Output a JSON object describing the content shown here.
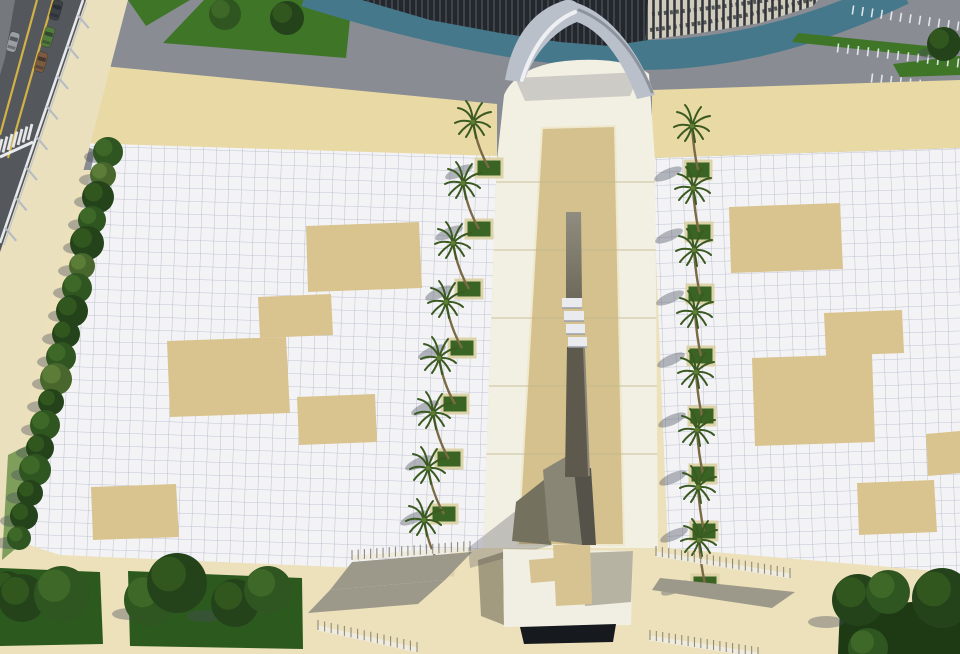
{
  "meta": {
    "label": "aerial-3d-architectural-render-monument-plaza",
    "canvas_w": 960,
    "canvas_h": 654
  },
  "palette": {
    "base": "#ece1ba",
    "asphalt": "#54575c",
    "median": "#75787d",
    "yellow": "#d2b245",
    "sidewalk": "#eae0bd",
    "rail": "#e6e9ed",
    "rail_post": "#b6bcc4",
    "pavement": "#898c92",
    "grass": "#3e7527",
    "grass_dark": "#2c5a1e",
    "lawn_dark": "#1e3a15",
    "tree_dark": "#24431a",
    "tree_mid": "#2f5520",
    "tree_light": "#49672c",
    "teal": "#45788b",
    "colonnade": "#24282d",
    "slat": "#3e444b",
    "facade": "#d0cbbc",
    "facade_win": "#33373c",
    "band": "#e9d9a4",
    "tile": "#f3f3f6",
    "tile_line": "#96a0b4",
    "patch": "#d9c48f",
    "walk_white": "#f2efe3",
    "walk_tan": "#d4c18d",
    "walk_border": "#efe8cd",
    "joint": "#c2b88f",
    "arch_mid": "#bac0ca",
    "arch_light": "#eef0f4",
    "arch_dark": "#8d939d",
    "mono_up_a": "#908d80",
    "mono_up_b": "#6e6a5b",
    "mono_low": "#5d594c",
    "mono_right": "#8a8578",
    "slab": "#e9ebee",
    "slab_edge": "#9aa0a8",
    "plat": "#f1eee4",
    "plat_shadow": "#b7b3a3",
    "pedestal": "#d6c391",
    "recess": "#16191d",
    "wedge": "#9d998a",
    "stripe_white": "#eef1f4",
    "shadow": "rgba(72,76,90,0.38)",
    "planter_frame": "#ddd3a8",
    "planter_grass": "#3a6423",
    "trunk": "#7b6a46",
    "frond": "#3a5a21",
    "frond_core": "#5d7d30"
  },
  "scene": {
    "top": {
      "pavement": [
        [
          0,
          0
        ],
        [
          960,
          0
        ],
        [
          960,
          170
        ],
        [
          0,
          170
        ]
      ],
      "grass_islands": [
        [
          [
            128,
            0
          ],
          [
            190,
            0
          ],
          [
            146,
            26
          ]
        ],
        [
          [
            204,
            0
          ],
          [
            352,
            0
          ],
          [
            346,
            58
          ],
          [
            163,
            43
          ]
        ]
      ],
      "island_trees": [
        [
          225,
          14,
          16,
          "M"
        ],
        [
          287,
          18,
          17,
          "D"
        ]
      ],
      "teal_path": "M 306,-8 C 420,28 520,48 610,54 C 700,60 800,40 902,-10",
      "teal_width": 30,
      "colonnade": [
        [
          362,
          0
        ],
        [
          430,
          20
        ],
        [
          500,
          33
        ],
        [
          560,
          42
        ],
        [
          610,
          46
        ],
        [
          648,
          40
        ],
        [
          652,
          0
        ]
      ],
      "facade": [
        [
          648,
          0
        ],
        [
          645,
          40
        ],
        [
          700,
          33
        ],
        [
          760,
          23
        ],
        [
          813,
          6
        ],
        [
          818,
          0
        ]
      ],
      "facade_bands": [
        "M 652,14 C 700,10 760,2 815,-8",
        "M 650,30 C 700,24 762,14 816,-2"
      ],
      "grass_strips": [
        [
          [
            798,
            33
          ],
          [
            938,
            47
          ],
          [
            932,
            57
          ],
          [
            792,
            42
          ]
        ],
        [
          [
            893,
            64
          ],
          [
            960,
            56
          ],
          [
            960,
            75
          ],
          [
            900,
            77
          ]
        ]
      ],
      "parking_rows": [
        {
          "x1": 853,
          "y1": 10,
          "x2": 958,
          "y2": 26,
          "n": 12
        },
        {
          "x1": 838,
          "y1": 48,
          "x2": 958,
          "y2": 63,
          "n": 13
        },
        {
          "x1": 872,
          "y1": 78,
          "x2": 958,
          "y2": 89,
          "n": 10
        }
      ],
      "corner_tree": [
        944,
        44,
        17,
        "D"
      ]
    },
    "bands": {
      "left": [
        [
          83,
          64
        ],
        [
          497,
          104
        ],
        [
          497,
          158
        ],
        [
          78,
          144
        ]
      ],
      "right": [
        [
          652,
          90
        ],
        [
          960,
          80
        ],
        [
          960,
          148
        ],
        [
          652,
          158
        ]
      ]
    },
    "plaza": {
      "left": [
        [
          78,
          143
        ],
        [
          497,
          156
        ],
        [
          483,
          548
        ],
        [
          360,
          568
        ],
        [
          60,
          555
        ],
        [
          14,
          540
        ],
        [
          95,
          150
        ]
      ],
      "right": [
        [
          652,
          158
        ],
        [
          960,
          148
        ],
        [
          960,
          573
        ],
        [
          725,
          553
        ],
        [
          668,
          548
        ]
      ],
      "patches_left": [
        [
          [
            306,
            226
          ],
          [
            419,
            222
          ],
          [
            422,
            288
          ],
          [
            308,
            292
          ]
        ],
        [
          [
            258,
            297
          ],
          [
            331,
            294
          ],
          [
            333,
            335
          ],
          [
            260,
            338
          ]
        ],
        [
          [
            167,
            341
          ],
          [
            286,
            337
          ],
          [
            290,
            413
          ],
          [
            170,
            417
          ]
        ],
        [
          [
            297,
            397
          ],
          [
            375,
            394
          ],
          [
            377,
            442
          ],
          [
            299,
            445
          ]
        ],
        [
          [
            91,
            487
          ],
          [
            176,
            484
          ],
          [
            179,
            537
          ],
          [
            93,
            540
          ]
        ]
      ],
      "patches_right": [
        [
          [
            729,
            207
          ],
          [
            840,
            203
          ],
          [
            843,
            269
          ],
          [
            731,
            273
          ]
        ],
        [
          [
            824,
            313
          ],
          [
            902,
            310
          ],
          [
            904,
            353
          ],
          [
            826,
            356
          ]
        ],
        [
          [
            752,
            358
          ],
          [
            872,
            354
          ],
          [
            875,
            442
          ],
          [
            755,
            446
          ]
        ],
        [
          [
            857,
            483
          ],
          [
            934,
            480
          ],
          [
            937,
            532
          ],
          [
            859,
            535
          ]
        ],
        [
          [
            926,
            434
          ],
          [
            960,
            431
          ],
          [
            960,
            473
          ],
          [
            928,
            476
          ]
        ]
      ]
    },
    "street": {
      "asphalt": [
        [
          0,
          0
        ],
        [
          86,
          0
        ],
        [
          0,
          252
        ]
      ],
      "median": [
        [
          0,
          0
        ],
        [
          15,
          0
        ],
        [
          5,
          58
        ],
        [
          0,
          75
        ]
      ],
      "yellow_lines": [
        [
          [
            37,
            0
          ],
          [
            0,
            135
          ]
        ],
        [
          [
            53,
            0
          ],
          [
            8,
            158
          ]
        ]
      ],
      "crosswalk": {
        "x1": 0,
        "y1": 147,
        "x2": 30,
        "y2": 132,
        "n": 7
      },
      "stop_line": [
        [
          0,
          157
        ],
        [
          33,
          142
        ]
      ],
      "rail": {
        "x1": 83,
        "y1": 0,
        "x2": 0,
        "y2": 243,
        "posts": 8
      },
      "cars": [
        {
          "x": 56,
          "y": 10,
          "c": "#3c4146"
        },
        {
          "x": 48,
          "y": 37,
          "c": "#527c3b"
        },
        {
          "x": 13,
          "y": 42,
          "c": "#9a9ea3"
        },
        {
          "x": 41,
          "y": 62,
          "c": "#7d5b40"
        }
      ],
      "sidewalk": [
        [
          83,
          0
        ],
        [
          128,
          0
        ],
        [
          60,
          260
        ],
        [
          18,
          450
        ],
        [
          0,
          540
        ],
        [
          0,
          243
        ]
      ],
      "grass_sliver": [
        [
          8,
          455
        ],
        [
          28,
          445
        ],
        [
          20,
          545
        ],
        [
          2,
          560
        ]
      ]
    },
    "hedge": [
      [
        108,
        152,
        15,
        "M"
      ],
      [
        103,
        175,
        13,
        "L"
      ],
      [
        98,
        197,
        16,
        "D"
      ],
      [
        92,
        220,
        14,
        "M"
      ],
      [
        87,
        243,
        17,
        "D"
      ],
      [
        82,
        266,
        13,
        "L"
      ],
      [
        77,
        288,
        15,
        "M"
      ],
      [
        72,
        311,
        16,
        "D"
      ],
      [
        66,
        334,
        14,
        "D"
      ],
      [
        61,
        357,
        15,
        "M"
      ],
      [
        56,
        379,
        16,
        "L"
      ],
      [
        51,
        402,
        13,
        "D"
      ],
      [
        45,
        425,
        15,
        "M"
      ],
      [
        40,
        448,
        14,
        "D"
      ],
      [
        35,
        470,
        16,
        "M"
      ],
      [
        30,
        493,
        13,
        "D"
      ],
      [
        24,
        516,
        14,
        "D"
      ],
      [
        19,
        538,
        12,
        "M"
      ]
    ],
    "walkway": {
      "outline": "M 497,160 L 504,95 C 512,76 535,64 565,61 C 605,57 636,63 649,74 L 655,160 L 658,548 L 483,548 Z",
      "tan": [
        [
          542,
          128
        ],
        [
          615,
          126
        ],
        [
          624,
          545
        ],
        [
          518,
          545
        ]
      ],
      "joints": [
        182,
        250,
        318,
        386,
        454
      ],
      "arch_shadow": [
        [
          515,
          78
        ],
        [
          640,
          72
        ],
        [
          630,
          96
        ],
        [
          525,
          101
        ]
      ]
    },
    "palms": {
      "left": [
        [
          473,
          122
        ],
        [
          463,
          183
        ],
        [
          453,
          243
        ],
        [
          446,
          302
        ],
        [
          439,
          358
        ],
        [
          433,
          413
        ],
        [
          428,
          468
        ],
        [
          424,
          520
        ]
      ],
      "right": [
        [
          692,
          126
        ],
        [
          693,
          188
        ],
        [
          694,
          250
        ],
        [
          695,
          312
        ],
        [
          696,
          372
        ],
        [
          697,
          430
        ],
        [
          698,
          487
        ],
        [
          699,
          540
        ]
      ],
      "planter_offset_left": [
        16,
        46
      ],
      "planter_offset_right": [
        6,
        44
      ]
    },
    "monument": {
      "shaft_upper": [
        [
          566,
          212
        ],
        [
          581,
          212
        ],
        [
          582,
          298
        ],
        [
          566,
          298
        ]
      ],
      "slabs": [
        [
          562,
          298,
          20,
          10
        ],
        [
          564,
          311,
          20,
          10
        ],
        [
          566,
          324,
          19,
          10
        ],
        [
          568,
          337,
          19,
          10
        ]
      ],
      "shaft_lower": [
        [
          567,
          347
        ],
        [
          584,
          347
        ],
        [
          589,
          477
        ],
        [
          565,
          477
        ]
      ],
      "base_mid": [
        [
          543,
          470
        ],
        [
          574,
          452
        ],
        [
          582,
          545
        ],
        [
          549,
          541
        ]
      ],
      "base_fin": [
        [
          516,
          502
        ],
        [
          545,
          479
        ],
        [
          551,
          545
        ],
        [
          512,
          541
        ]
      ],
      "base_right": [
        [
          574,
          470
        ],
        [
          591,
          468
        ],
        [
          596,
          545
        ],
        [
          582,
          545
        ]
      ],
      "ground_shadow": [
        [
          468,
          548
        ],
        [
          540,
          492
        ],
        [
          552,
          545
        ],
        [
          470,
          568
        ]
      ]
    },
    "platform": {
      "top": [
        [
          503,
          549
        ],
        [
          633,
          551
        ],
        [
          631,
          625
        ],
        [
          504,
          627
        ]
      ],
      "shadow": [
        [
          580,
          553
        ],
        [
          633,
          551
        ],
        [
          631,
          602
        ],
        [
          585,
          606
        ]
      ],
      "pedestal_v": [
        [
          553,
          545
        ],
        [
          590,
          543
        ],
        [
          592,
          604
        ],
        [
          556,
          606
        ]
      ],
      "pedestal_arm": [
        [
          529,
          560
        ],
        [
          554,
          558
        ],
        [
          555,
          581
        ],
        [
          531,
          583
        ]
      ],
      "recess": [
        [
          520,
          627
        ],
        [
          616,
          624
        ],
        [
          613,
          642
        ],
        [
          524,
          644
        ]
      ],
      "left_shade": [
        [
          478,
          560
        ],
        [
          503,
          552
        ],
        [
          504,
          625
        ],
        [
          481,
          616
        ]
      ]
    },
    "ramps": {
      "left": {
        "rows": [
          {
            "x1": 352,
            "y1": 558,
            "x2": 470,
            "y2": 549,
            "n": 20
          },
          {
            "x1": 318,
            "y1": 628,
            "x2": 417,
            "y2": 650,
            "n": 16
          }
        ],
        "wedges": [
          [
            [
              352,
              562
            ],
            [
              472,
              552
            ],
            [
              445,
              580
            ],
            [
              330,
              590
            ]
          ],
          [
            [
              330,
              590
            ],
            [
              445,
              580
            ],
            [
              418,
              604
            ],
            [
              308,
              613
            ]
          ]
        ]
      },
      "right": {
        "rows": [
          {
            "x1": 656,
            "y1": 554,
            "x2": 790,
            "y2": 576,
            "n": 22
          },
          {
            "x1": 650,
            "y1": 638,
            "x2": 758,
            "y2": 655,
            "n": 18
          }
        ],
        "wedges": [
          [
            [
              660,
              578
            ],
            [
              795,
              592
            ],
            [
              772,
              608
            ],
            [
              652,
              590
            ]
          ]
        ]
      }
    },
    "lawns": {
      "panels": [
        [
          [
            0,
            568
          ],
          [
            100,
            572
          ],
          [
            103,
            644
          ],
          [
            0,
            646
          ]
        ],
        [
          [
            128,
            571
          ],
          [
            302,
            578
          ],
          [
            303,
            649
          ],
          [
            130,
            646
          ]
        ],
        [
          [
            840,
            608
          ],
          [
            960,
            598
          ],
          [
            960,
            654
          ],
          [
            838,
            654
          ]
        ]
      ],
      "trees": [
        [
          8,
          585,
          14,
          "D"
        ],
        [
          22,
          598,
          24,
          "D"
        ],
        [
          62,
          594,
          28,
          "M"
        ],
        [
          150,
          600,
          26,
          "M"
        ],
        [
          177,
          583,
          30,
          "D"
        ],
        [
          235,
          603,
          24,
          "D"
        ],
        [
          268,
          590,
          24,
          "M"
        ],
        [
          858,
          600,
          26,
          "D"
        ],
        [
          888,
          592,
          22,
          "M"
        ],
        [
          942,
          598,
          30,
          "D"
        ],
        [
          868,
          648,
          20,
          "M"
        ]
      ],
      "shadows": [
        [
          130,
          614
        ],
        [
          205,
          616
        ],
        [
          826,
          622
        ]
      ]
    },
    "arch": {
      "fill": "M 505,80 C 512,38 532,12 560,2 C 566,-1 572,-1 577,3 C 610,14 638,50 655,95 L 637,99 C 622,58 600,30 577,22 C 556,30 534,52 524,82 Z",
      "highlight": "M 522,80 C 532,48 550,22 575,12",
      "shade": "M 652,92 C 636,52 610,22 579,10"
    }
  }
}
